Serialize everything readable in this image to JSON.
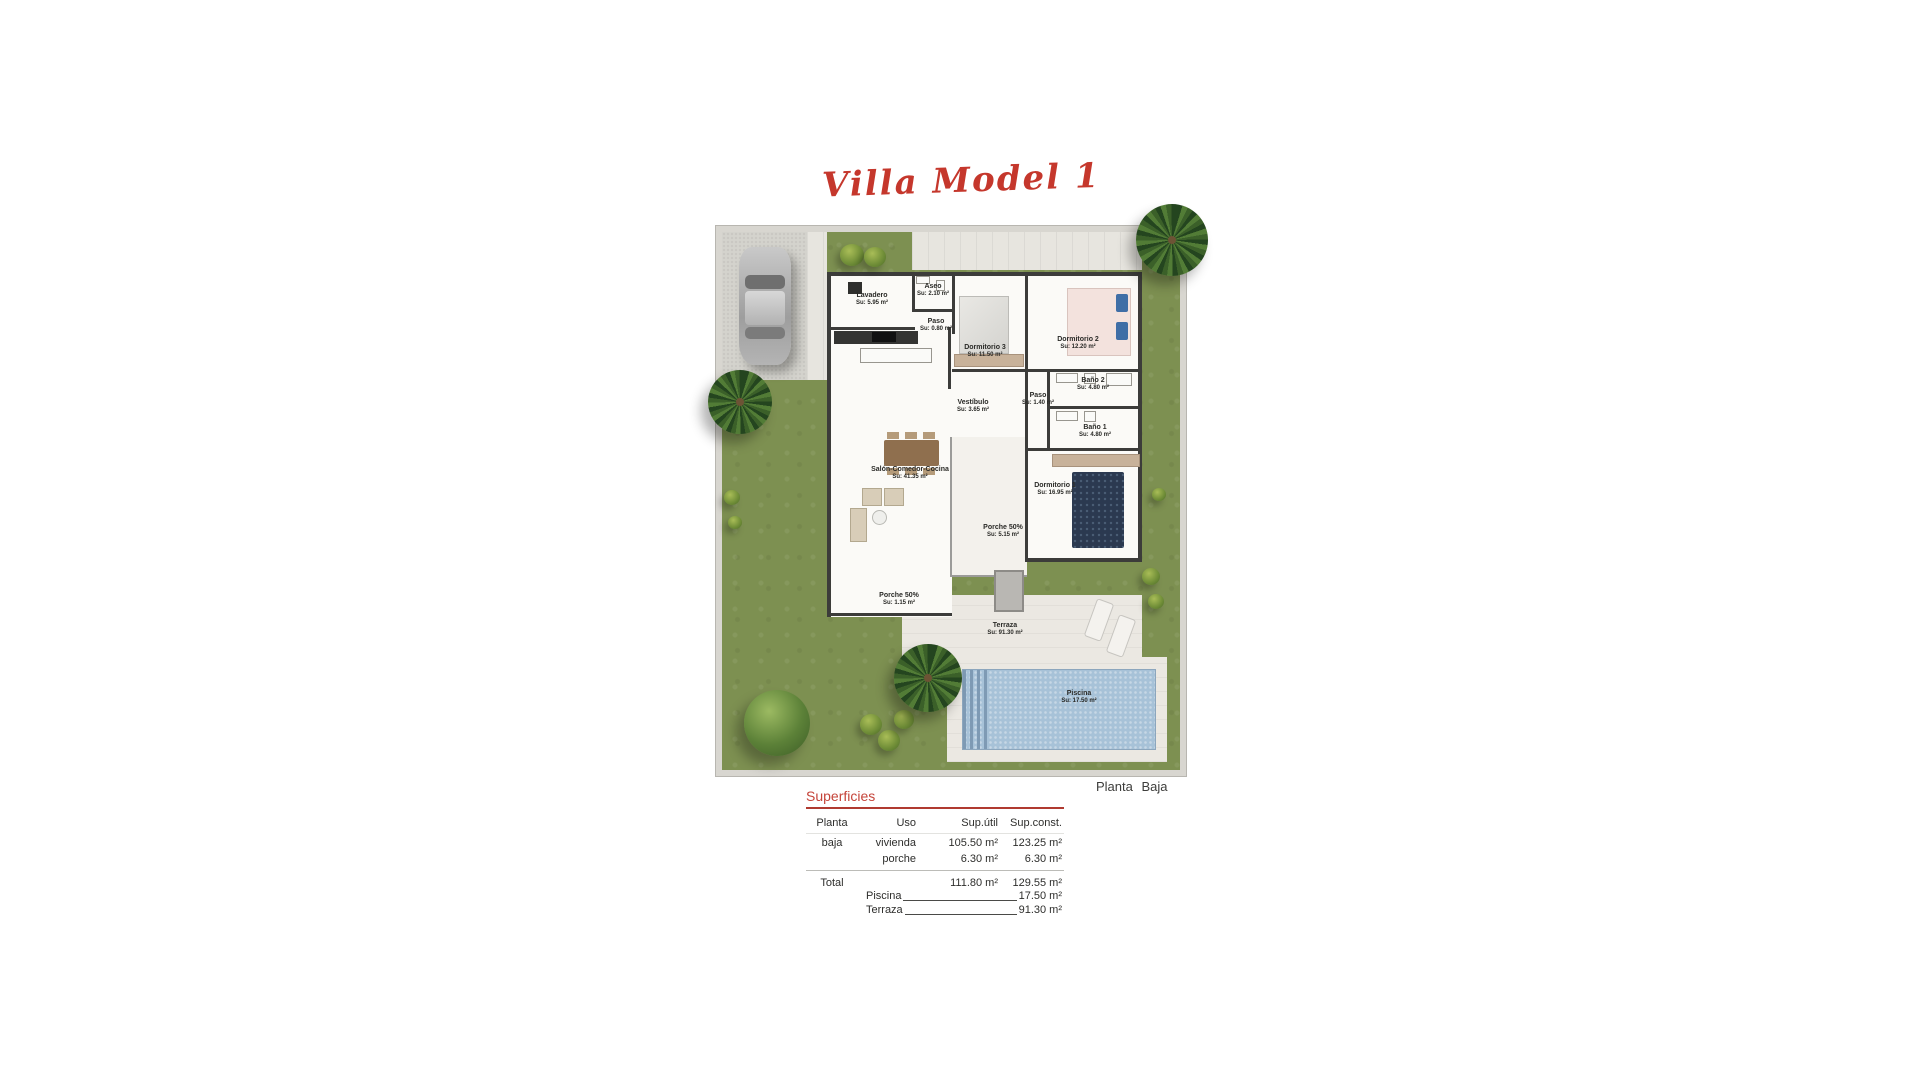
{
  "title": "Villa Model 1",
  "plan_caption": "Planta Baja",
  "rooms": [
    {
      "name": "Lavadero",
      "area": "Su: 5.95 m²"
    },
    {
      "name": "Aseo",
      "area": "Su: 2.10 m²"
    },
    {
      "name": "Paso",
      "area": "Su: 0.80 m²"
    },
    {
      "name": "Dormitorio 3",
      "area": "Su: 11.50 m²"
    },
    {
      "name": "Dormitorio 2",
      "area": "Su: 12.20 m²"
    },
    {
      "name": "Baño 2",
      "area": "Su: 4.80 m²"
    },
    {
      "name": "Paso",
      "area": "Su: 1.40 m²"
    },
    {
      "name": "Baño 1",
      "area": "Su: 4.80 m²"
    },
    {
      "name": "Vestíbulo",
      "area": "Su: 3.65 m²"
    },
    {
      "name": "Dormitorio 1",
      "area": "Su: 16.95 m²"
    },
    {
      "name": "Salón-Comedor-Cocina",
      "area": "Su: 41.35 m²"
    },
    {
      "name": "Porche 50%",
      "area": "Su: 5.15 m²"
    },
    {
      "name": "Porche 50%",
      "area": "Su: 1.15 m²"
    },
    {
      "name": "Terraza",
      "area": "Su: 91.30 m²"
    },
    {
      "name": "Piscina",
      "area": "Su: 17.50 m²"
    }
  ],
  "superficies": {
    "title": "Superficies",
    "headers": [
      "Planta",
      "Uso",
      "Sup.útil",
      "Sup.const."
    ],
    "rows": [
      [
        "baja",
        "vivienda",
        "105.50 m²",
        "123.25 m²"
      ],
      [
        "",
        "porche",
        "6.30 m²",
        "6.30 m²"
      ]
    ],
    "total": [
      "Total",
      "",
      "111.80 m²",
      "129.55 m²"
    ]
  },
  "extras": [
    {
      "label": "Piscina",
      "value": "17.50 m²"
    },
    {
      "label": "Terraza",
      "value": "91.30 m²"
    }
  ],
  "colors": {
    "accent_red": "#c5372c",
    "grass_green": "#7d9051",
    "pool_blue": "#a7c2d8",
    "wall_dark": "#3c3c3a",
    "paving_gray": "#e7e5df"
  }
}
